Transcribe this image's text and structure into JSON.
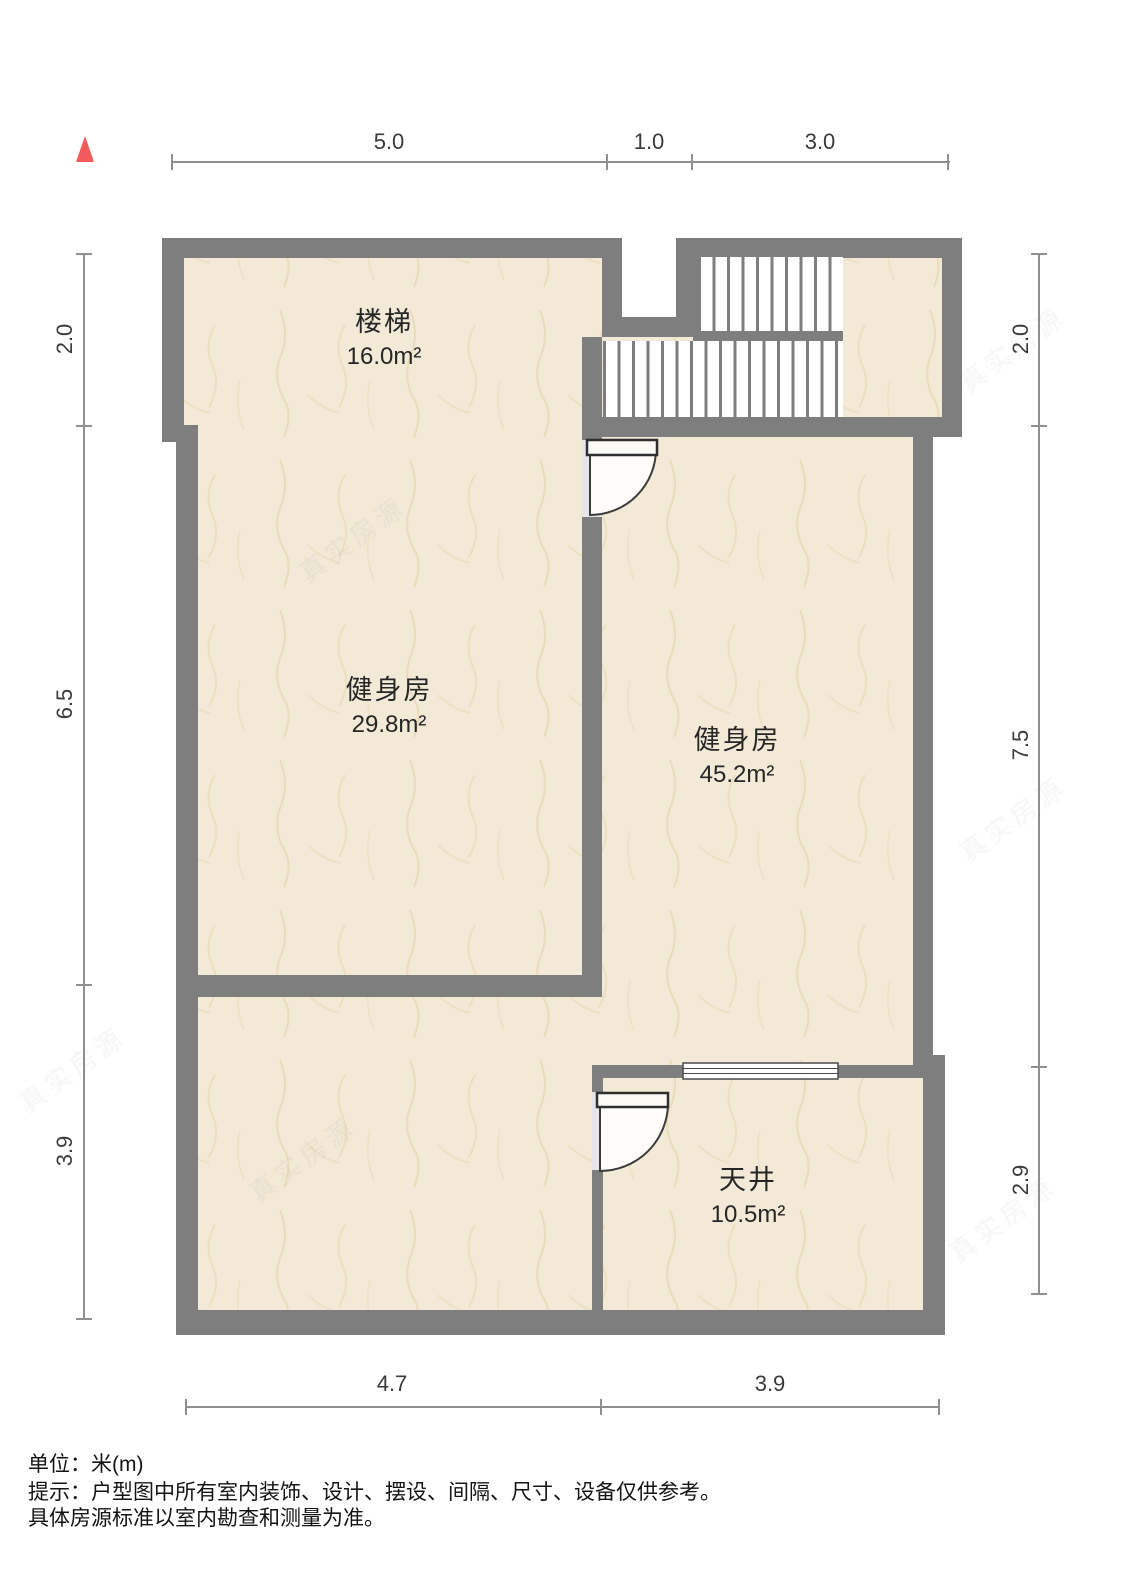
{
  "plan": {
    "compass": "north-indicator",
    "watermark": "真实房源",
    "rooms": [
      {
        "name": "楼梯",
        "area": "16.0m²"
      },
      {
        "name": "健身房",
        "area": "29.8m²"
      },
      {
        "name": "健身房",
        "area": "45.2m²"
      },
      {
        "name": "天井",
        "area": "10.5m²"
      }
    ],
    "dimensions": {
      "top": [
        "5.0",
        "1.0",
        "3.0"
      ],
      "bottom": [
        "4.7",
        "3.9"
      ],
      "left": [
        "2.0",
        "6.5",
        "3.9"
      ],
      "right": [
        "2.0",
        "7.5",
        "2.9"
      ]
    },
    "notes": {
      "unit": "单位：米(m)",
      "tip": "提示：户型图中所有室内装饰、设计、摆设、间隔、尺寸、设备仅供参考。",
      "tip2": "具体房源标准以室内勘查和测量为准。"
    },
    "colors": {
      "wall": "#7e7e7e",
      "floor": "#f2e9d6",
      "vein": "#e3cfa4",
      "door_gap": "#e7e4ea",
      "north_red": "#f15b5b",
      "dim_line": "#8f8f8f",
      "text": "#262626"
    }
  }
}
